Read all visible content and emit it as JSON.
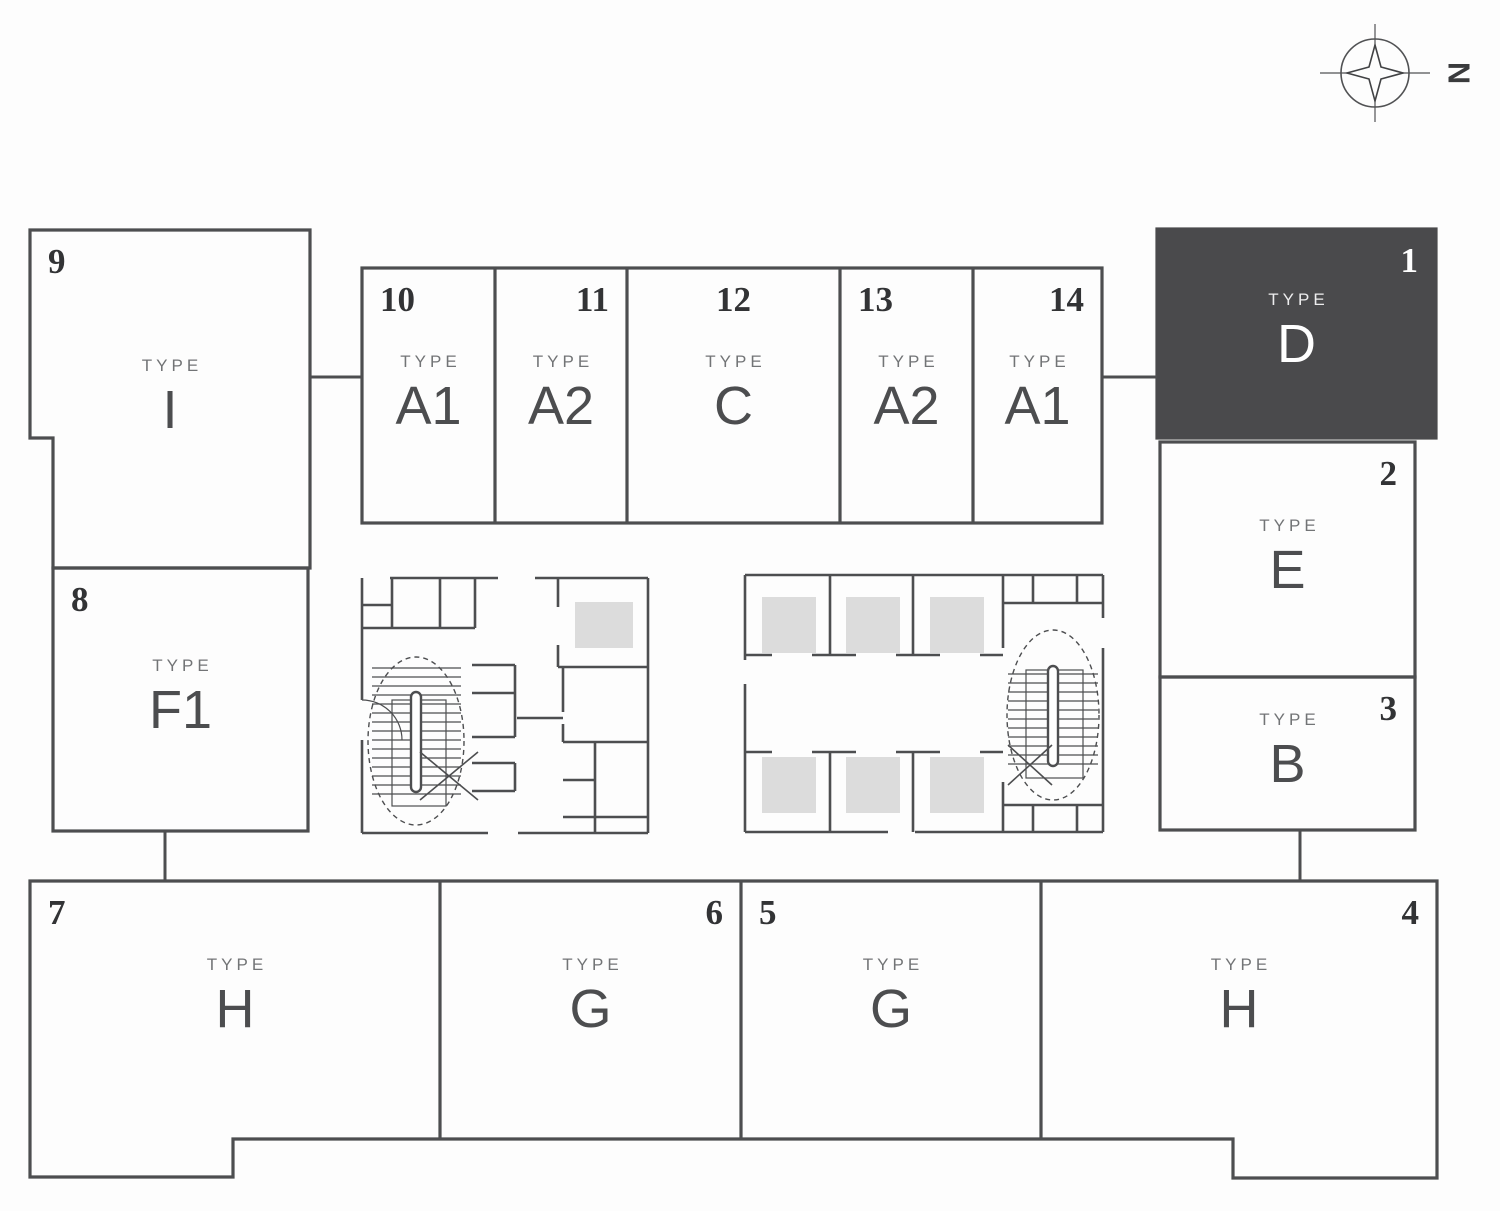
{
  "labels": {
    "type_prefix": "TYPE"
  },
  "compass": {
    "label": "N"
  },
  "colors": {
    "outline": "#4d4e50",
    "highlight_fill": "#4a4a4c",
    "highlight_text": "#ffffff",
    "number_text": "#323335",
    "type_label_text": "#727476",
    "letter_text": "#4c4d4f",
    "shaft_fill": "#dcdcdc"
  },
  "units": [
    {
      "number": "1",
      "type": "D",
      "highlighted": true
    },
    {
      "number": "2",
      "type": "E",
      "highlighted": false
    },
    {
      "number": "3",
      "type": "B",
      "highlighted": false
    },
    {
      "number": "4",
      "type": "H",
      "highlighted": false
    },
    {
      "number": "5",
      "type": "G",
      "highlighted": false
    },
    {
      "number": "6",
      "type": "G",
      "highlighted": false
    },
    {
      "number": "7",
      "type": "H",
      "highlighted": false
    },
    {
      "number": "8",
      "type": "F1",
      "highlighted": false
    },
    {
      "number": "9",
      "type": "I",
      "highlighted": false
    },
    {
      "number": "10",
      "type": "A1",
      "highlighted": false
    },
    {
      "number": "11",
      "type": "A2",
      "highlighted": false
    },
    {
      "number": "12",
      "type": "C",
      "highlighted": false
    },
    {
      "number": "13",
      "type": "A2",
      "highlighted": false
    },
    {
      "number": "14",
      "type": "A1",
      "highlighted": false
    }
  ]
}
